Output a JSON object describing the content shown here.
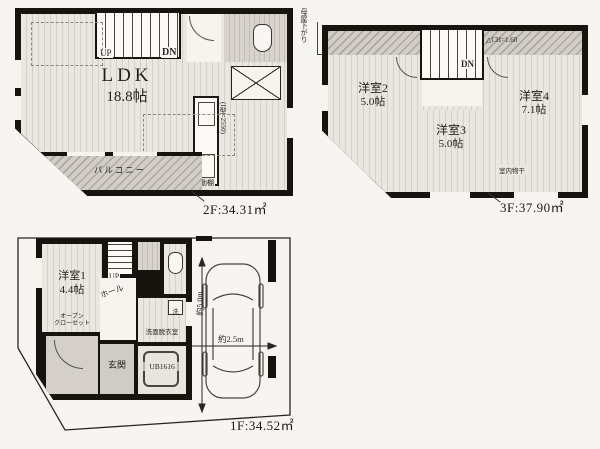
{
  "plan2f": {
    "room_ldk": {
      "name": "LDK",
      "size": "18.8帖"
    },
    "stairs_up": "UP",
    "stairs_dn": "DN",
    "kitchen_note": "(I型=2550)",
    "shelf_note": "可動棚",
    "balcony": "バルコニー",
    "area": "2F:34.31㎡"
  },
  "plan3f": {
    "roof_note": "母屋下がり",
    "ceiling_note": "△CH=1.60",
    "stairs_dn": "DN",
    "rooms": [
      {
        "name": "洋室2",
        "size": "5.0帖"
      },
      {
        "name": "洋室3",
        "size": "5.0帖"
      },
      {
        "name": "洋室4",
        "size": "7.1帖"
      }
    ],
    "drying_note": "室内物干",
    "area": "3F:37.90㎡"
  },
  "plan1f": {
    "room1": {
      "name": "洋室1",
      "size": "4.4帖"
    },
    "closet_line1": "オープン",
    "closet_line2": "クローゼット",
    "stairs_up": "UP",
    "hall": "ホール",
    "washroom": "洗面脱衣室",
    "washer": "洗",
    "entrance": "玄関",
    "bath": "UB1616",
    "car_width": "約2.5m",
    "car_length": "約5.0m",
    "area": "1F:34.52㎡"
  }
}
